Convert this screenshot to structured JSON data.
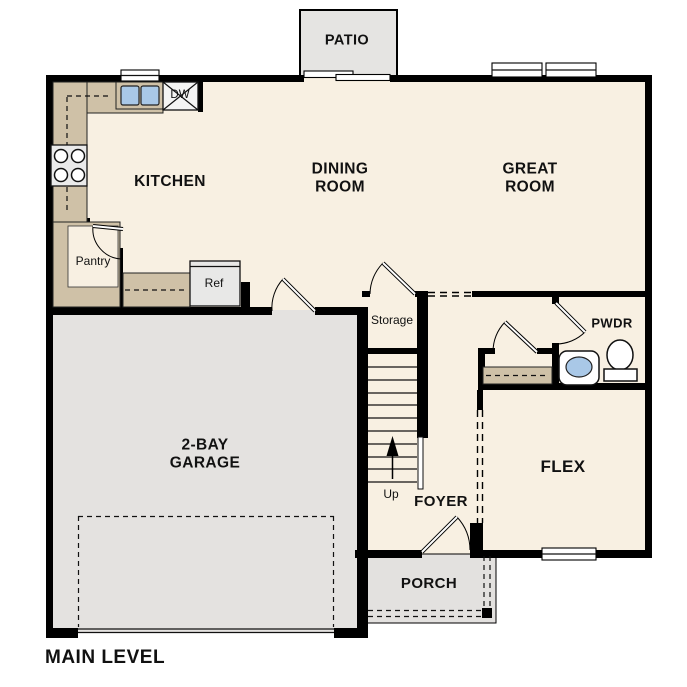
{
  "title": "MAIN LEVEL",
  "labels": {
    "patio": "PATIO",
    "kitchen": "KITCHEN",
    "dining_room": "DINING\nROOM",
    "great_room": "GREAT\nROOM",
    "pantry": "Pantry",
    "dishwasher": "DW",
    "refrigerator": "Ref",
    "storage": "Storage",
    "powder_room": "PWDR",
    "garage": "2-BAY\nGARAGE",
    "flex": "FLEX",
    "foyer": "FOYER",
    "up": "Up",
    "porch": "PORCH"
  },
  "colors": {
    "wall": "#000000",
    "floor": "#f8f0e2",
    "garage_floor": "#e4e2e0",
    "patio_floor": "#e5e4e2",
    "porch_floor": "#e3e1df",
    "counter": "#cfc1a7",
    "sink_blue": "#a9c8e7",
    "appliance": "#eaeaea",
    "text": "#111111"
  }
}
